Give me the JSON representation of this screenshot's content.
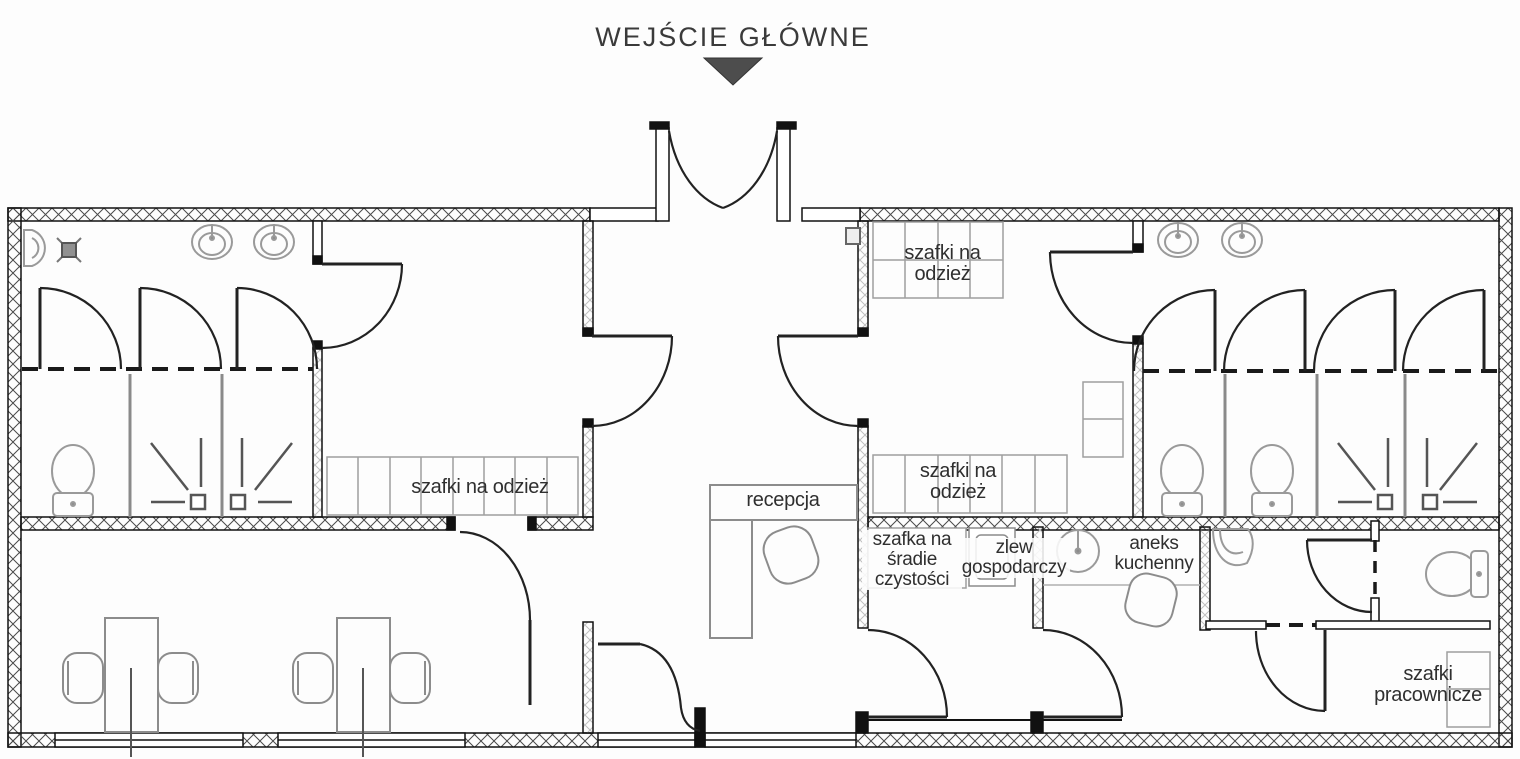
{
  "title": {
    "text": "WEJŚCIE GŁÓWNE"
  },
  "colors": {
    "wall": "#1a1a1a",
    "fixture": "#8c8c8c",
    "label": "#2f2f2f",
    "arrow": "#4d4d4d",
    "background": "#fdfdfd"
  },
  "rooms": {
    "left_locker_room": {
      "label": "szafki na odzież"
    },
    "right_locker_room_top": {
      "label": "szafki na odzież"
    },
    "right_locker_room_bottom": {
      "label": "szafki na odzież"
    },
    "reception": {
      "label": "recepcja"
    },
    "cleaning_room": {
      "cabinet_label": "szafka na śradie czystości",
      "sink_label": "zlew gospodarczy"
    },
    "kitchenette": {
      "label": "aneks kuchenny"
    },
    "staff_room": {
      "label": "szafki pracownicze"
    }
  }
}
